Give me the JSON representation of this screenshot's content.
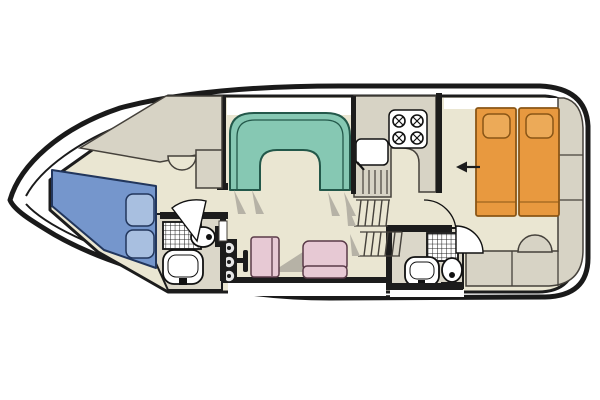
{
  "canvas": {
    "width": 600,
    "height": 400,
    "background": "#ffffff"
  },
  "colors": {
    "deck": "#ffffff",
    "hull_stroke": "#1a1a1a",
    "wall": "#1c1c1c",
    "floor": "#eae6d2",
    "bath_floor": "#dbd7c9",
    "cabinet": "#d7d3c5",
    "cabinet_stroke": "#45413b",
    "dinette": "#86c8b3",
    "dinette_stroke": "#23584a",
    "bed_fwd": "#7596cc",
    "bed_fwd_stroke": "#22365c",
    "pillow_fwd": "#a8bfe0",
    "bed_aft": "#e8993f",
    "bed_aft_stroke": "#8a5616",
    "pillow_aft": "#ecaa58",
    "seat": "#e7c9d4",
    "seat_stroke": "#5a3a48",
    "fixture_fill": "#ffffff",
    "fixture_stroke": "#111111",
    "shadow": "#b6b2a6"
  },
  "boat": {
    "type": "motor-yacht-floor-plan",
    "orientation": "bow-left",
    "rooms": [
      {
        "id": "bow-cabin",
        "fixtures": [
          "double-berth",
          "pillows",
          "wardrobe",
          "vanity-half-round"
        ]
      },
      {
        "id": "forward-bathroom",
        "fixtures": [
          "shower",
          "toilet",
          "washbasin",
          "door-swing"
        ]
      },
      {
        "id": "salon",
        "fixtures": [
          "u-shaped-dinette",
          "helm-console",
          "throttle-lever",
          "helm-seat",
          "bench-seat"
        ]
      },
      {
        "id": "galley",
        "fixtures": [
          "sink-with-drainer",
          "four-burner-stove",
          "counter",
          "companionway-steps"
        ]
      },
      {
        "id": "aft-bathroom",
        "fixtures": [
          "shower",
          "toilet",
          "washbasin",
          "door-swing"
        ]
      },
      {
        "id": "aft-cabin",
        "fixtures": [
          "twin-bed-left",
          "twin-bed-right",
          "pillows",
          "entry-arrow",
          "stern-stool",
          "stern-cabinets"
        ]
      }
    ]
  }
}
